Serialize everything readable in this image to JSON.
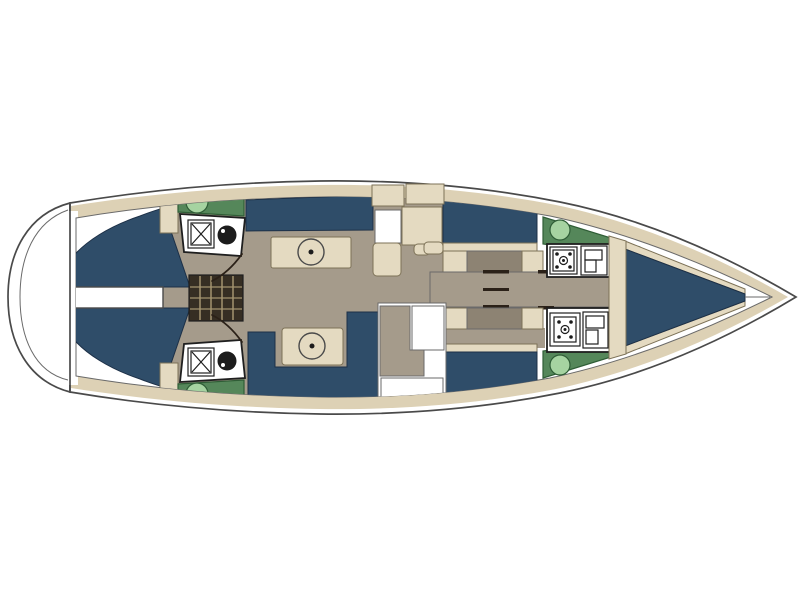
{
  "plan": {
    "type": "sailing-yacht-interior-floor-plan",
    "orientation": "bow-right-stern-left"
  },
  "colors": {
    "background": "#ffffff",
    "hull_white": "#ffffff",
    "deck_band_tan": "#ddd1b5",
    "interior_floor_taupe": "#a59b8b",
    "cabin_floor_dark": "#8d8373",
    "upholstery_navy": "#2f4d69",
    "furniture_tan": "#e4dac1",
    "counter_green": "#55875a",
    "sink_light_green": "#a6d3a1",
    "fixture_white": "#ffffff",
    "fixture_outline": "#1c1c1c",
    "stairs_dark": "#362e23",
    "stairs_tread": "#a3936f",
    "detail_line": "#2b2118"
  },
  "regions": [
    {
      "id": "swim-platform",
      "label": "stern swim platform"
    },
    {
      "id": "port-aft-cabin",
      "label": "port aft double cabin"
    },
    {
      "id": "starboard-aft-cabin",
      "label": "starboard aft double cabin"
    },
    {
      "id": "aft-center-walkway",
      "label": "center walkway between aft cabins"
    },
    {
      "id": "companionway",
      "label": "companionway steps"
    },
    {
      "id": "port-aft-head",
      "label": "port aft head with shower and toilet"
    },
    {
      "id": "starboard-aft-head",
      "label": "starboard aft head with shower and toilet"
    },
    {
      "id": "salon",
      "label": "salon with twin settees and tables"
    },
    {
      "id": "galley",
      "label": "galley cabinetry"
    },
    {
      "id": "port-mid-cabin",
      "label": "port midship double cabin"
    },
    {
      "id": "starboard-mid-cabin",
      "label": "starboard midship double cabin"
    },
    {
      "id": "center-corridor",
      "label": "centerline corridor"
    },
    {
      "id": "port-fwd-head",
      "label": "port forward head with shower and toilet"
    },
    {
      "id": "starboard-fwd-head",
      "label": "starboard forward head with shower and toilet"
    },
    {
      "id": "bow-cabin",
      "label": "forward V-berth cabin"
    },
    {
      "id": "bow-locker",
      "label": "bow anchor locker"
    }
  ]
}
